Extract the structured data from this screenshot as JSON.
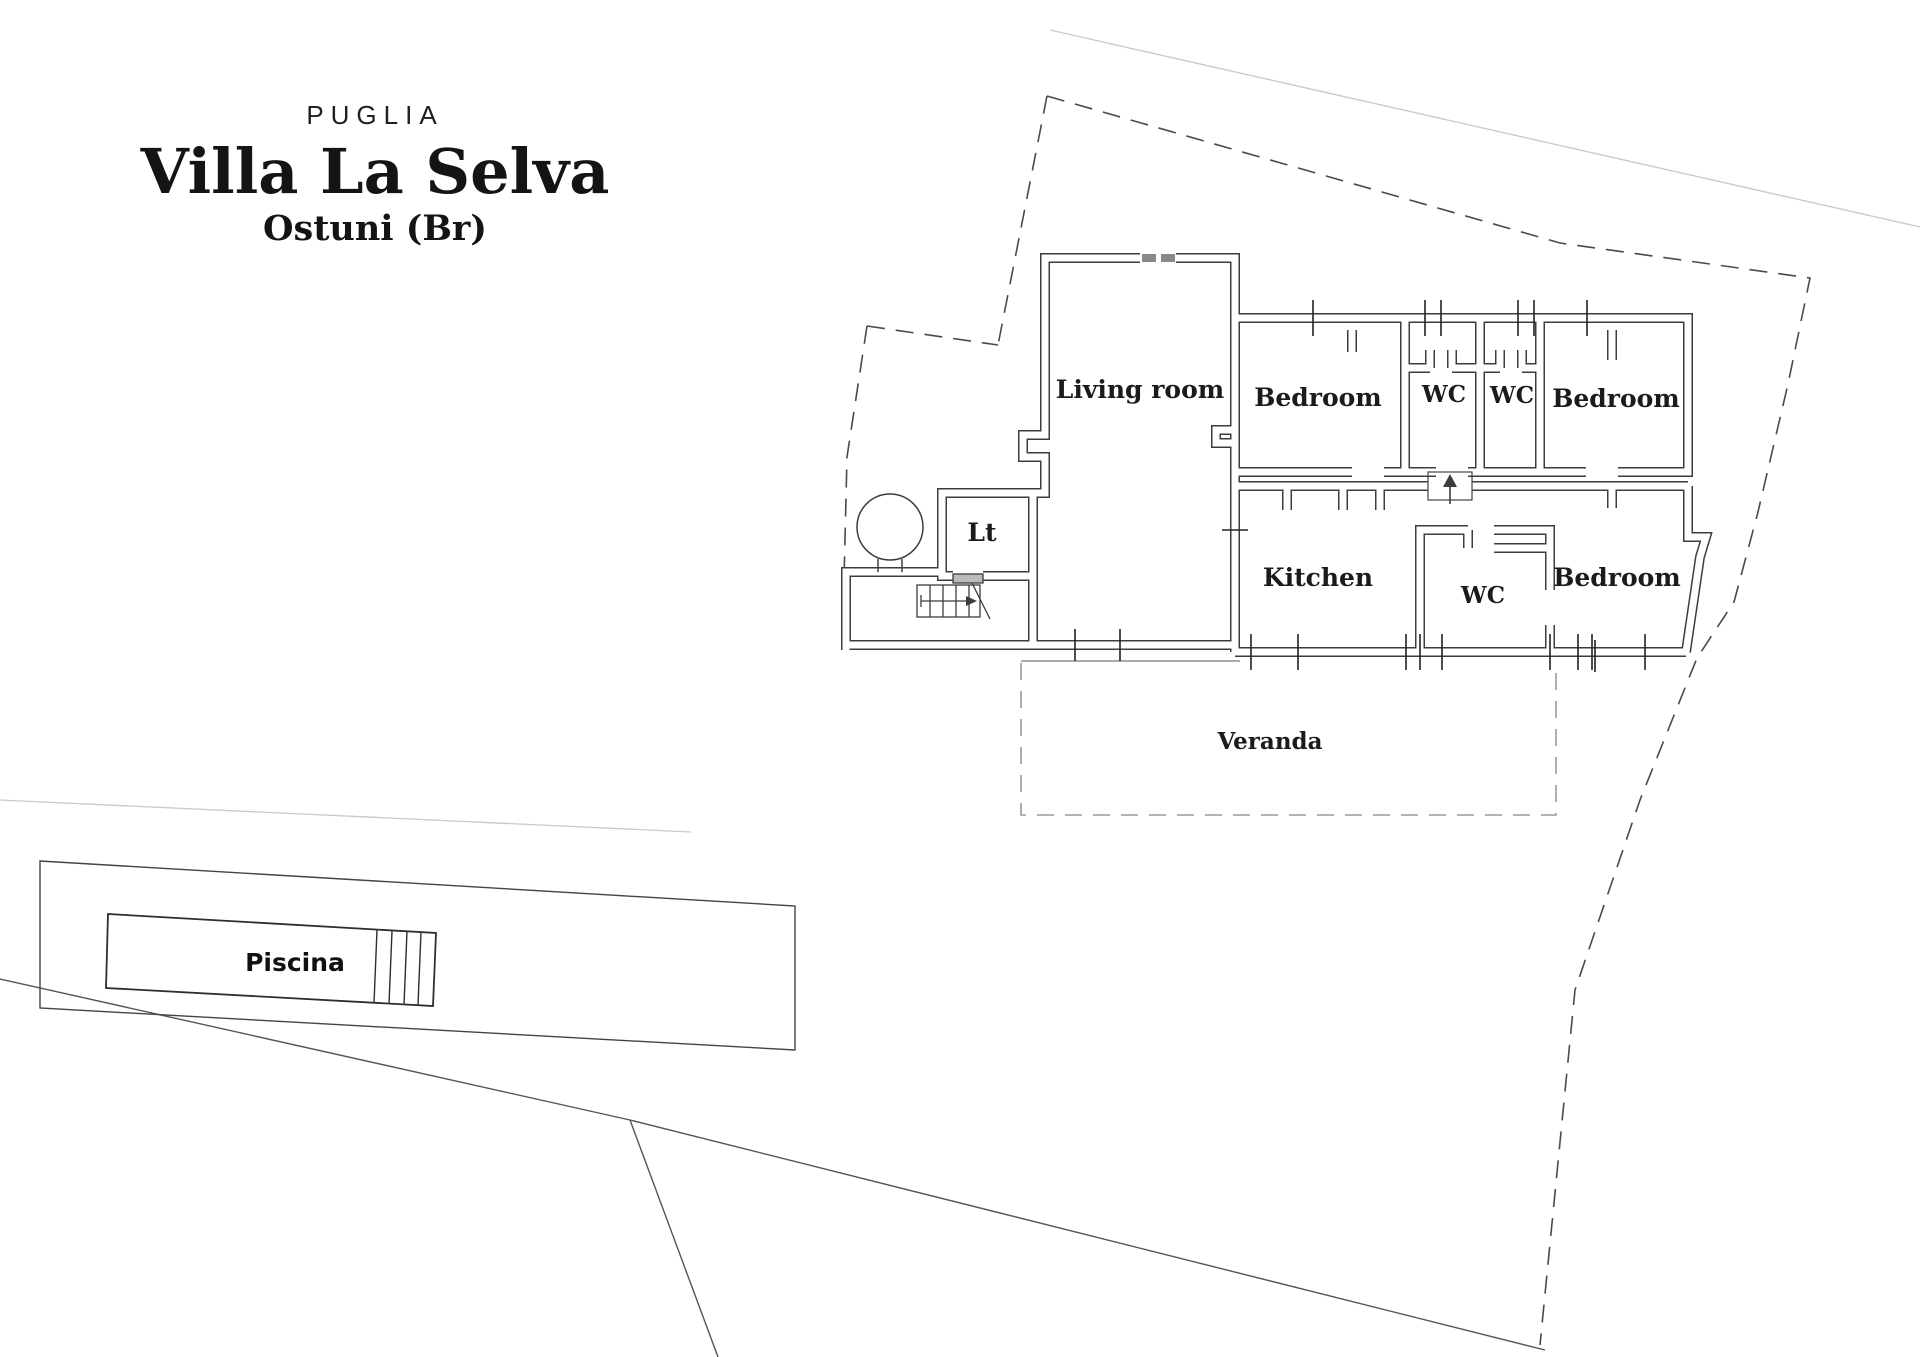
{
  "title": {
    "region": "PUGLIA",
    "name": "Villa La Selva",
    "location": "Ostuni (Br)"
  },
  "plan": {
    "rooms": [
      {
        "id": "living-room",
        "label": "Living room",
        "x": 1140,
        "y": 398
      },
      {
        "id": "bedroom-1",
        "label": "Bedroom",
        "x": 1318,
        "y": 406
      },
      {
        "id": "wc-1",
        "label": "WC",
        "x": 1444,
        "y": 402
      },
      {
        "id": "wc-2",
        "label": "WC",
        "x": 1512,
        "y": 403
      },
      {
        "id": "bedroom-2",
        "label": "Bedroom",
        "x": 1616,
        "y": 407
      },
      {
        "id": "lt",
        "label": "Lt",
        "x": 982,
        "y": 541
      },
      {
        "id": "kitchen",
        "label": "Kitchen",
        "x": 1318,
        "y": 586
      },
      {
        "id": "wc-3",
        "label": "WC",
        "x": 1483,
        "y": 603
      },
      {
        "id": "bedroom-3",
        "label": "Bedroom",
        "x": 1617,
        "y": 586
      },
      {
        "id": "veranda",
        "label": "Veranda",
        "x": 1270,
        "y": 749
      }
    ],
    "outdoor": {
      "pool_label": "Piscina",
      "x": 295,
      "y": 971
    }
  },
  "colors": {
    "wall": "#3d3d3d",
    "text": "#1b1b1b",
    "boundary_dash": "#4a4a4a",
    "faint_line": "#c9c9c9",
    "veranda_dash": "#9a9a9a"
  }
}
